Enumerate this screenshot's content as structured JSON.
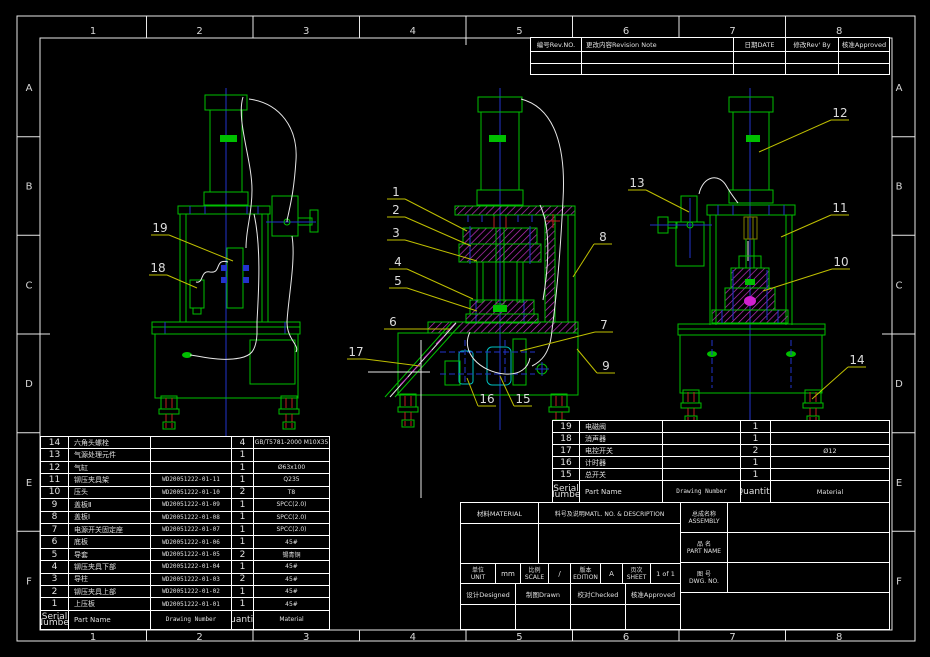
{
  "colors": {
    "background": "#000000",
    "cad_green": "#00bf00",
    "centerline_blue": "#2233cc",
    "hatch_magenta": "#bf30bf",
    "leader_yellow": "#bfbf00",
    "frame_white": "#ffffff",
    "detail_red": "#bf2020",
    "switch_cyan": "#00bfbf"
  },
  "frame": {
    "zones_top": [
      "1",
      "2",
      "3",
      "4",
      "5",
      "6",
      "7",
      "8"
    ],
    "zones_bottom": [
      "1",
      "2",
      "3",
      "4",
      "5",
      "6",
      "7",
      "8"
    ],
    "zones_left": [
      "A",
      "B",
      "C",
      "D",
      "E",
      "F"
    ],
    "zones_right": [
      "A",
      "B",
      "C",
      "D",
      "E",
      "F"
    ]
  },
  "revision_table": {
    "headers": [
      "编号Rev.NO.",
      "更改内容Revision Note",
      "日期DATE",
      "修改Rev' By",
      "核准Approved"
    ],
    "empty_row_count": 2
  },
  "parts_table_main": {
    "columns": [
      "Serial Number",
      "Part Name",
      "Drawing Number",
      "Quantity",
      "Material"
    ],
    "rows": [
      [
        "14",
        "六角头螺栓",
        "",
        "4",
        "GB/T5781-2000 M10X35"
      ],
      [
        "13",
        "气源处理元件",
        "",
        "1",
        ""
      ],
      [
        "12",
        "气缸",
        "",
        "1",
        "Ø63x100"
      ],
      [
        "11",
        "铆压夹具架",
        "WD20051222-01-11",
        "1",
        "Q235"
      ],
      [
        "10",
        "压头",
        "WD20051222-01-10",
        "2",
        "T8"
      ],
      [
        "9",
        "盖板Ⅱ",
        "WD20051222-01-09",
        "1",
        "SPCC(2.0)"
      ],
      [
        "8",
        "盖板Ⅰ",
        "WD20051222-01-08",
        "1",
        "SPCC(2.0)"
      ],
      [
        "7",
        "电源开关固定座",
        "WD20051222-01-07",
        "1",
        "SPCC(2.0)"
      ],
      [
        "6",
        "底板",
        "WD20051222-01-06",
        "1",
        "45#"
      ],
      [
        "5",
        "导套",
        "WD20051222-01-05",
        "2",
        "锡青铜"
      ],
      [
        "4",
        "铆压夹具下部",
        "WD20051222-01-04",
        "1",
        "45#"
      ],
      [
        "3",
        "导柱",
        "WD20051222-01-03",
        "2",
        "45#"
      ],
      [
        "2",
        "铆压夹具上部",
        "WD20051222-01-02",
        "1",
        "45#"
      ],
      [
        "1",
        "上压板",
        "WD20051222-01-01",
        "1",
        "45#"
      ]
    ]
  },
  "parts_table_right": {
    "columns": [
      "Serial Number",
      "Part Name",
      "Drawing Number",
      "Quantity",
      "Material"
    ],
    "rows": [
      [
        "19",
        "电磁阀",
        "",
        "1",
        ""
      ],
      [
        "18",
        "消声器",
        "",
        "1",
        ""
      ],
      [
        "17",
        "电控开关",
        "",
        "2",
        "Ø12"
      ],
      [
        "16",
        "计时器",
        "",
        "1",
        ""
      ],
      [
        "15",
        "总开关",
        "",
        "1",
        ""
      ]
    ]
  },
  "title_block": {
    "material_label": "材料MATERIAL",
    "description_label": "料号及说明MATL. NO. & DESCRIPTION",
    "assembly": {
      "cn": "总成名称",
      "en": "ASSEMBLY"
    },
    "part_name": {
      "cn": "品  名",
      "en": "PART NAME"
    },
    "dwg_no": {
      "cn": "图  号",
      "en": "DWG. NO."
    },
    "unit": {
      "cn": "单位",
      "en": "UNIT",
      "value": "mm"
    },
    "scale": {
      "cn": "比例",
      "en": "SCALE",
      "value": "/"
    },
    "edition": {
      "cn": "版本",
      "en": "EDITION",
      "value": "A"
    },
    "sheet": {
      "cn": "页次",
      "en": "SHEET",
      "value": "1 of 1"
    },
    "designed_label": "设计Designed",
    "drawn_label": "制图Drawn",
    "checked_label": "校对Checked",
    "approved_label": "核准Approved"
  },
  "balloons": [
    {
      "n": "19",
      "x": 160,
      "y": 232,
      "tx": 233,
      "ty": 261
    },
    {
      "n": "18",
      "x": 158,
      "y": 272,
      "tx": 197,
      "ty": 288
    },
    {
      "n": "1",
      "x": 396,
      "y": 196,
      "tx": 467,
      "ty": 231
    },
    {
      "n": "2",
      "x": 396,
      "y": 214,
      "tx": 471,
      "ty": 246
    },
    {
      "n": "3",
      "x": 396,
      "y": 237,
      "tx": 477,
      "ty": 261
    },
    {
      "n": "4",
      "x": 398,
      "y": 266,
      "tx": 473,
      "ty": 299
    },
    {
      "n": "5",
      "x": 398,
      "y": 285,
      "tx": 477,
      "ty": 311
    },
    {
      "n": "6",
      "x": 393,
      "y": 326,
      "tx": 450,
      "ty": 329
    },
    {
      "n": "17",
      "x": 356,
      "y": 356,
      "tx": 420,
      "ty": 366
    },
    {
      "n": "16",
      "x": 487,
      "y": 403,
      "tx": 467,
      "ty": 378
    },
    {
      "n": "15",
      "x": 523,
      "y": 403,
      "tx": 500,
      "ty": 376
    },
    {
      "n": "7",
      "x": 604,
      "y": 329,
      "tx": 520,
      "ty": 351
    },
    {
      "n": "9",
      "x": 606,
      "y": 370,
      "tx": 577,
      "ty": 349
    },
    {
      "n": "8",
      "x": 603,
      "y": 241,
      "tx": 573,
      "ty": 277
    },
    {
      "n": "12",
      "x": 840,
      "y": 117,
      "tx": 759,
      "ty": 152
    },
    {
      "n": "13",
      "x": 637,
      "y": 187,
      "tx": 689,
      "ty": 212
    },
    {
      "n": "11",
      "x": 840,
      "y": 212,
      "tx": 781,
      "ty": 237
    },
    {
      "n": "10",
      "x": 841,
      "y": 266,
      "tx": 763,
      "ty": 291
    },
    {
      "n": "14",
      "x": 857,
      "y": 364,
      "tx": 812,
      "ty": 399
    }
  ]
}
